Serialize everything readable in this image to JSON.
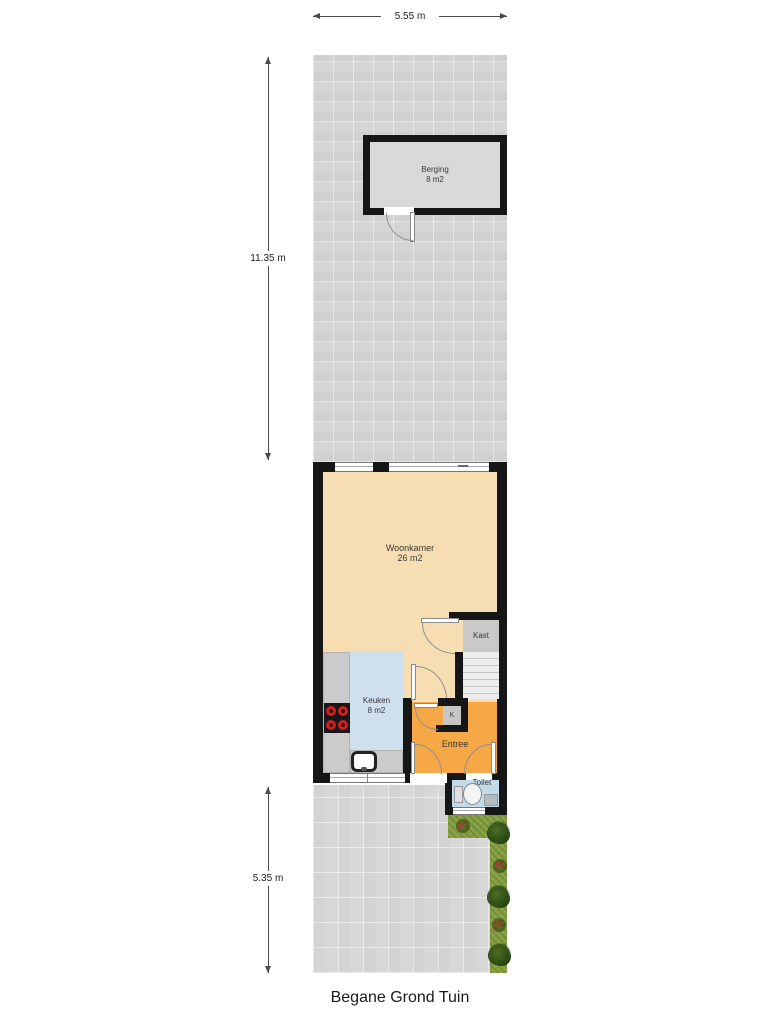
{
  "title": "Begane Grond Tuin",
  "dimensions": {
    "plot_width": "5.55 m",
    "garden_top_depth": "11.35 m",
    "garden_bottom_depth": "5.35 m"
  },
  "rooms": {
    "berging": {
      "name": "Berging",
      "area": "8 m2"
    },
    "woonkamer": {
      "name": "Woonkamer",
      "area": "26 m2"
    },
    "keuken": {
      "name": "Keuken",
      "area": "8 m2"
    },
    "kast": {
      "name": "Kast"
    },
    "kast_klein": {
      "name": "K"
    },
    "entree": {
      "name": "Entree"
    },
    "toilet": {
      "name": "Toilet"
    }
  },
  "colors": {
    "wall": "#161616",
    "woonkamer_floor": "#f6ddb2",
    "keuken_floor": "#cedfee",
    "entree_floor": "#f6a847",
    "toilet_floor": "#c3daea",
    "kast_floor": "#c9c9c9",
    "berging_floor": "#d9d9d9",
    "garden_paving": "#d5d5d5",
    "grass": "#84a040"
  }
}
